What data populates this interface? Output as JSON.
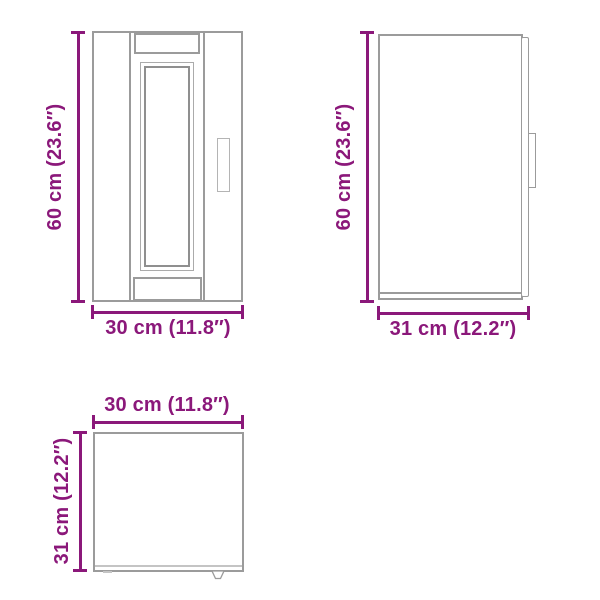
{
  "page": {
    "kind": "product-dimension-diagram",
    "background": "#ffffff"
  },
  "colors": {
    "dimension_accent": "#8b187a",
    "outline_gray": "#9b9b9b",
    "outline_dark_gray": "#8f8f8f",
    "outline_light_gray": "#b4b4b4"
  },
  "views": {
    "front_view": {
      "height_dimension": "60 cm (23.6″)",
      "width_dimension": "30 cm (11.8″)"
    },
    "side_view": {
      "height_dimension": "60 cm (23.6″)",
      "depth_dimension": "31 cm (12.2″)"
    },
    "top_view": {
      "width_dimension": "30 cm (11.8″)",
      "depth_dimension": "31 cm (12.2″)"
    }
  }
}
